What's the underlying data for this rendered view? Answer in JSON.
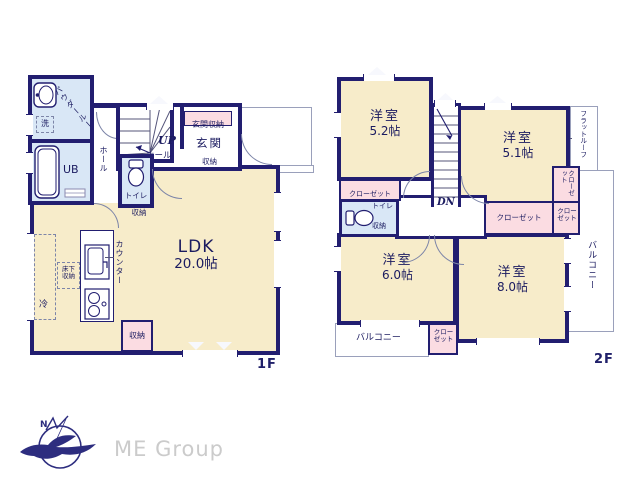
{
  "colors": {
    "wall": "#221e70",
    "room_cream": "#f7ecca",
    "wet_blue": "#d9e7f6",
    "closet_pink": "#fbdce2",
    "label_navy": "#1b1b60",
    "logo_navy": "#2d2d7f",
    "brand_gray": "#cbcbcb"
  },
  "floor1": {
    "label": "1F",
    "ldk": {
      "name": "LDK",
      "size": "20.0帖"
    },
    "powder_room": "パウダールーム",
    "laundry": "洗",
    "unit_bath": "UB",
    "hall_side": "ホール",
    "toilet": "トイレ",
    "toilet_storage": "収納",
    "stairs_up": "UP",
    "hall": "ホール",
    "entrance_storage": "玄関収納",
    "entrance": "玄関",
    "entrance_closet": "収納",
    "counter": "カウンター",
    "underfloor_storage": "床下収納",
    "fridge": "冷",
    "ldk_storage": "収納"
  },
  "floor2": {
    "label": "2F",
    "rooms": {
      "r52": {
        "name": "洋室",
        "size": "5.2帖"
      },
      "r51": {
        "name": "洋室",
        "size": "5.1帖"
      },
      "r60": {
        "name": "洋室",
        "size": "6.0帖"
      },
      "r80": {
        "name": "洋室",
        "size": "8.0帖"
      }
    },
    "closet_r52": "クローゼット",
    "toilet": "トイレ",
    "toilet_storage": "収納",
    "stairs_down": "DN",
    "closet_r51": "クローゼット",
    "closet_hall_wide": "クローゼット",
    "closet_hall_small": "クローゼット",
    "closet_r60": "クローゼット",
    "balcony_south": "バルコニー",
    "balcony_east": "バルコニー",
    "flat_roof": "フラットルーフ"
  },
  "branding": {
    "company": "ME Group",
    "compass_north": "N"
  }
}
